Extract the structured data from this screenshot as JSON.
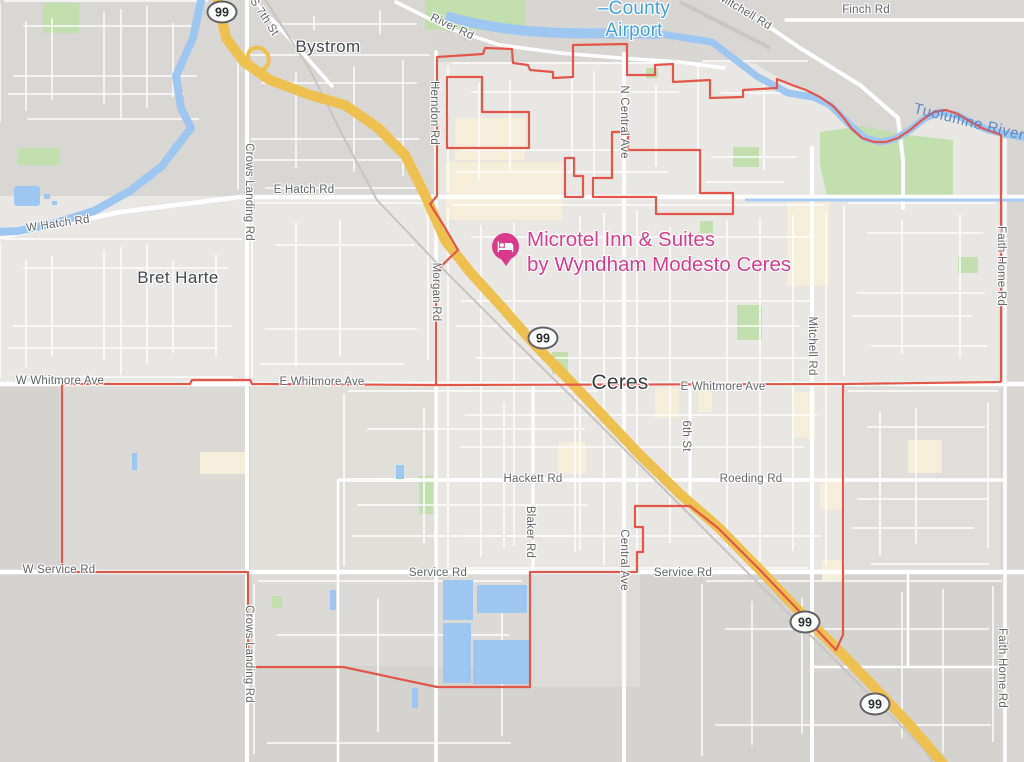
{
  "colors": {
    "boundary_red": "#e2574a",
    "highway_fill": "#fbe187",
    "highway_casing": "#eec04f",
    "water_blue": "#9dc6f0",
    "park_green": "#c3dfae",
    "poi_pink": "#d93a8c",
    "airport_blue": "#43a2d9",
    "beige": "#f5eedb"
  },
  "shield_label": "99",
  "towns": {
    "bystrom": "Bystrom",
    "bret_harte": "Bret Harte",
    "ceres": "Ceres"
  },
  "airport": {
    "label": "–County\nAirport"
  },
  "water_labels": {
    "tuolumne_river": "Tuolumne River"
  },
  "poi": {
    "hotel_name": "Microtel Inn & Suites\nby Wyndham Modesto Ceres"
  },
  "roads": {
    "river_rd": "River Rd",
    "s_7th_st": "S 7th St",
    "herndon_rd": "Herndon Rd",
    "crows_landing_rd": "Crows Landing Rd",
    "morgan_rd": "Morgan Rd",
    "e_hatch_rd": "E Hatch Rd",
    "w_hatch_rd": "W Hatch Rd",
    "n_central_ave": "N Central Ave",
    "central_ave": "Central Ave",
    "mitchell_rd": "Mitchell Rd",
    "finch_rd": "Finch Rd",
    "faith_home_rd": "Faith Home Rd",
    "w_whitmore_ave": "W Whitmore Ave",
    "e_whitmore_ave": "E Whitmore Ave",
    "w_service_rd": "W Service Rd",
    "service_rd": "Service Rd",
    "hackett_rd": "Hackett Rd",
    "roeding_rd": "Roeding Rd",
    "blaker_rd": "Blaker Rd",
    "sixth_st": "6th St"
  }
}
